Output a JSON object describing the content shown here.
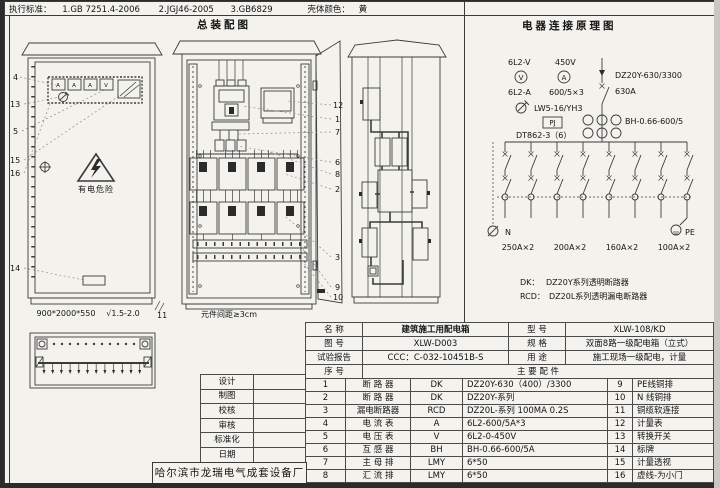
{
  "header": {
    "standards_label": "执行标准：",
    "standard1": "1.GB 7251.4-2006",
    "standard2": "2.JGJ46-2005",
    "standard3": "3.GB6829",
    "shell_color_label": "壳体颜色：",
    "shell_color_value": "黄",
    "assembly_title": "总装配图",
    "schematic_title": "电器连接原理图"
  },
  "front_view": {
    "callouts": [
      "4",
      "13",
      "5",
      "15",
      "16",
      "14"
    ],
    "callout_bottom_right": "11",
    "meters": [
      "A",
      "A",
      "A",
      "V"
    ],
    "warning_text": "有电危险",
    "dimensions": "900*2000*550",
    "finish": "√1.5-2.0"
  },
  "middle_view": {
    "callouts": [
      "12",
      "1",
      "7",
      "6",
      "8",
      "2",
      "3",
      "9",
      "10"
    ],
    "note": "元件间距≥3cm"
  },
  "schematic": {
    "voltmeter_label": "6L2-V",
    "voltage": "450V",
    "voltmeter_symbol": "V",
    "ammeter_symbol": "A",
    "ammeter_label": "6L2-A",
    "ct_ratio": "600/5×3",
    "selector_model": "LW5-16/YH3",
    "pj_label": "PJ",
    "energy_meter_model": "DT862-3（6）",
    "main_breaker_model": "DZ20Y-630/3300",
    "main_breaker_current": "630A",
    "ct_model": "BH-0.66-600/5",
    "n_label": "N",
    "pe_label": "PE",
    "ratings": [
      "250A×2",
      "200A×2",
      "160A×2",
      "100A×2"
    ],
    "legend_dk_key": "DK：",
    "legend_dk_value": "DZ20Y系列透明断路器",
    "legend_rcd_key": "RCD：",
    "legend_rcd_value": "DZ20L系列透明漏电断路器"
  },
  "info_table": {
    "rows": [
      {
        "l": "名    称",
        "v": "建筑施工用配电箱",
        "l2": "型    号",
        "v2": "XLW-108/KD"
      },
      {
        "l": "图    号",
        "v": "XLW-D003",
        "l2": "规    格",
        "v2": "双面8路一级配电箱（立式）"
      },
      {
        "l": "试验报告",
        "v": "CCC：C-032-10451B-S",
        "l2": "用    途",
        "v2": "施工现场一级配电，计量"
      }
    ],
    "seq_header": "序  号",
    "parts_header": "主  要  配  件"
  },
  "parts_table": {
    "rows": [
      {
        "no": "1",
        "name": "断  路  器",
        "code": "DK",
        "spec": "DZ20Y-630（400）/3300",
        "no2": "9",
        "name2": "PE线铜排"
      },
      {
        "no": "2",
        "name": "断  路  器",
        "code": "DK",
        "spec": "DZ20Y-系列",
        "no2": "10",
        "name2": "N 线铜排"
      },
      {
        "no": "3",
        "name": "漏电断路器",
        "code": "RCD",
        "spec": "DZ20L-系列 100MA 0.2S",
        "no2": "11",
        "name2": "铜缆软连接"
      },
      {
        "no": "4",
        "name": "电  流  表",
        "code": "A",
        "spec": "6L2-600/5A*3",
        "no2": "12",
        "name2": "计量表"
      },
      {
        "no": "5",
        "name": "电  压  表",
        "code": "V",
        "spec": "6L2-0-450V",
        "no2": "13",
        "name2": "转换开关"
      },
      {
        "no": "6",
        "name": "互  感  器",
        "code": "BH",
        "spec": "BH-0.66-600/5A",
        "no2": "14",
        "name2": "标牌"
      },
      {
        "no": "7",
        "name": "主  母  排",
        "code": "LMY",
        "spec": "6*50",
        "no2": "15",
        "name2": "计量透视"
      },
      {
        "no": "8",
        "name": "汇  流  排",
        "code": "LMY",
        "spec": "6*50",
        "no2": "16",
        "name2": "虚线-为小门"
      }
    ]
  },
  "title_block": {
    "rows": [
      "设计",
      "制图",
      "校核",
      "审核",
      "标准化",
      "日期"
    ],
    "company": "哈尔滨市龙瑞电气成套设备厂"
  }
}
